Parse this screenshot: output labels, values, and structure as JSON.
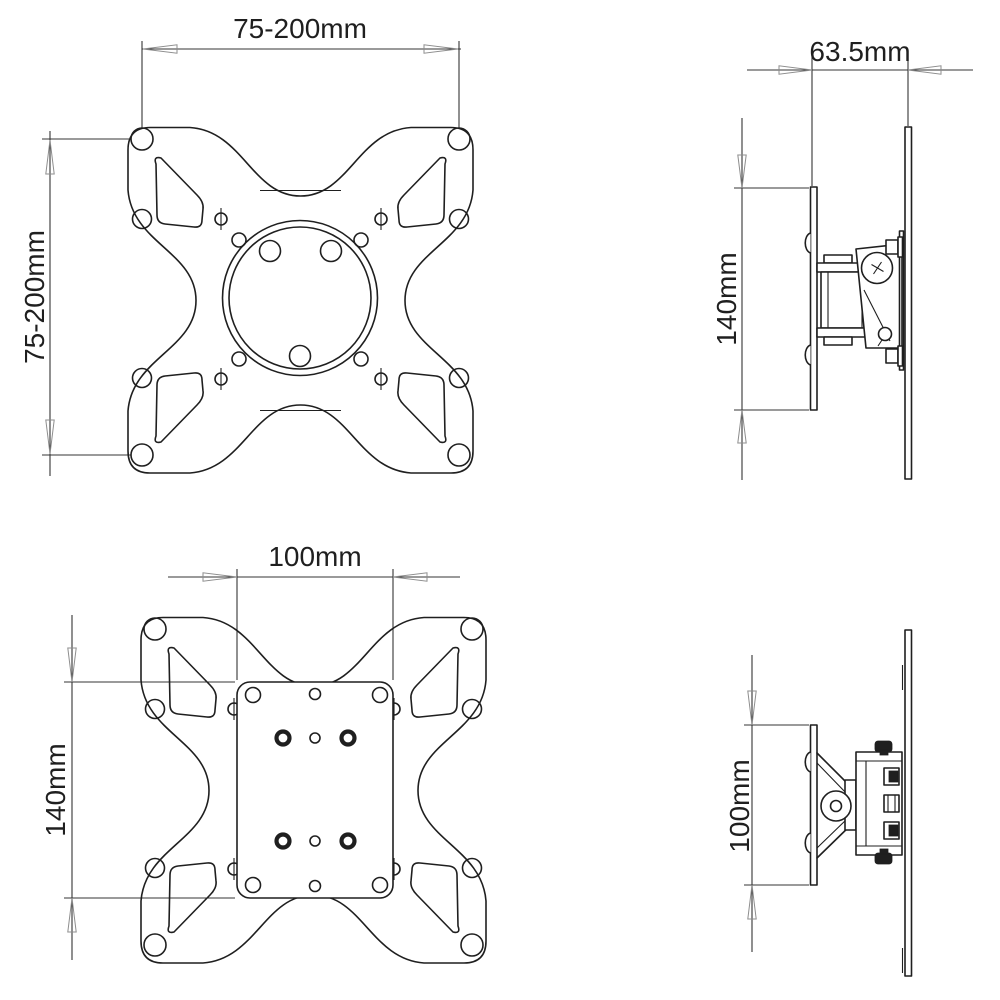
{
  "colors": {
    "background": "#ffffff",
    "line": "#1f1f1f",
    "dimension": "#343434",
    "arrow": "#8d8d8d"
  },
  "views": {
    "front_upper": {
      "width_dim": "75-200mm",
      "height_dim": "75-200mm"
    },
    "side_upper": {
      "depth_dim": "63.5mm",
      "height_dim": "140mm"
    },
    "front_lower": {
      "width_dim": "100mm",
      "height_dim": "140mm"
    },
    "side_lower": {
      "height_dim": "100mm"
    }
  }
}
